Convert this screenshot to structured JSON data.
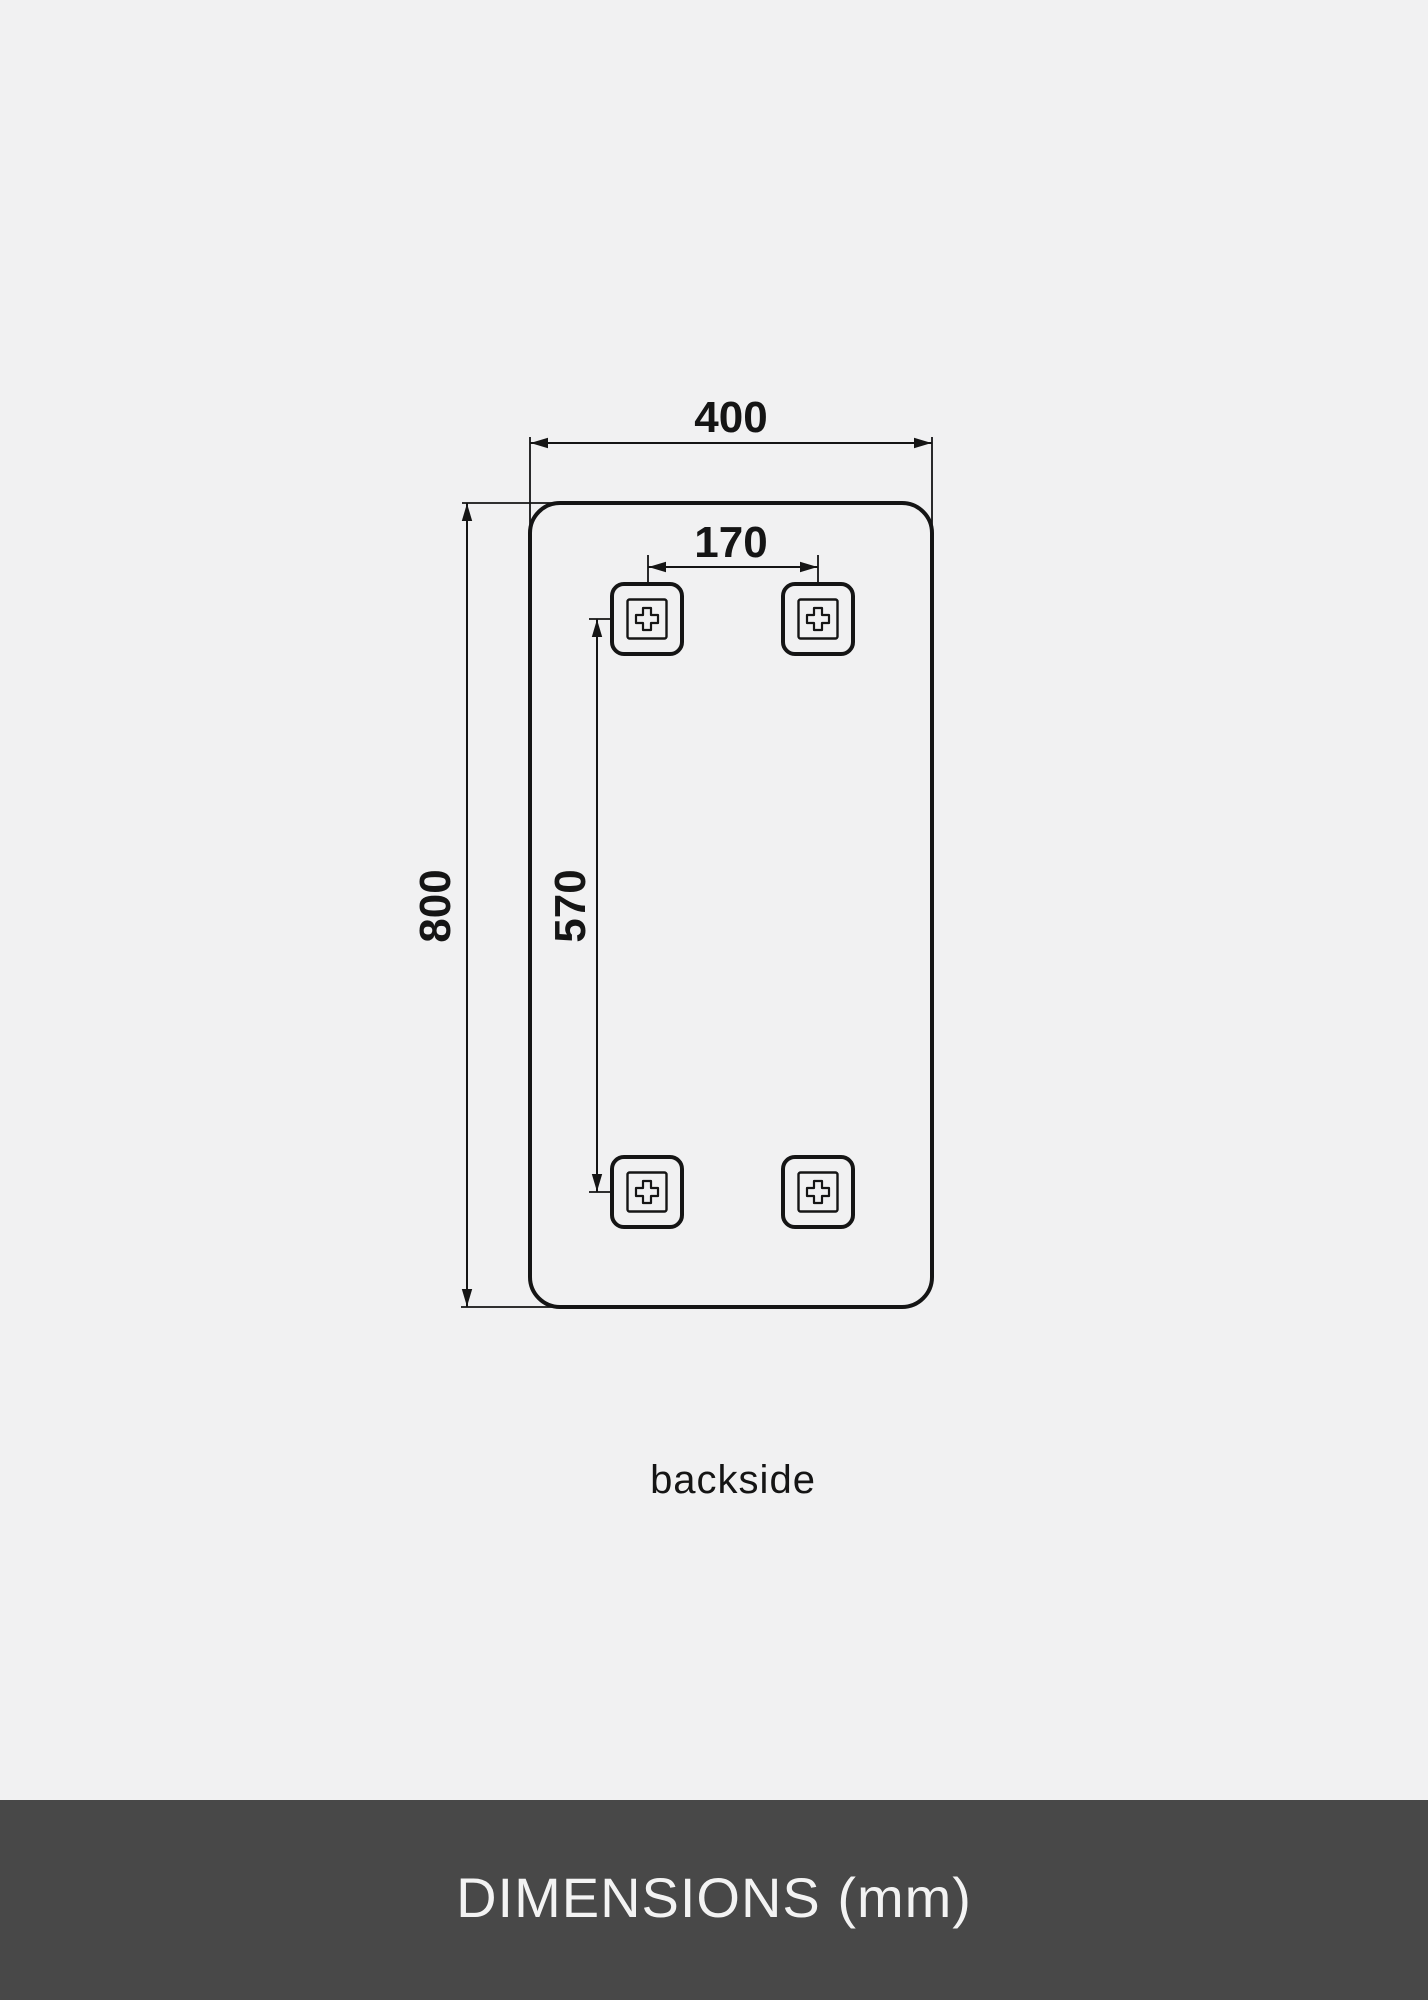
{
  "colors": {
    "page-bg": "#f1f1f2",
    "line": "#151515",
    "footer-bg": "#484848",
    "footer-text": "#f3f3f3"
  },
  "diagram": {
    "width_label": "400",
    "height_label": "800",
    "bracket_spacing_label": "170",
    "bracket_offset_label": "570",
    "caption": "backside"
  },
  "footer": {
    "title": "DIMENSIONS (mm)"
  }
}
